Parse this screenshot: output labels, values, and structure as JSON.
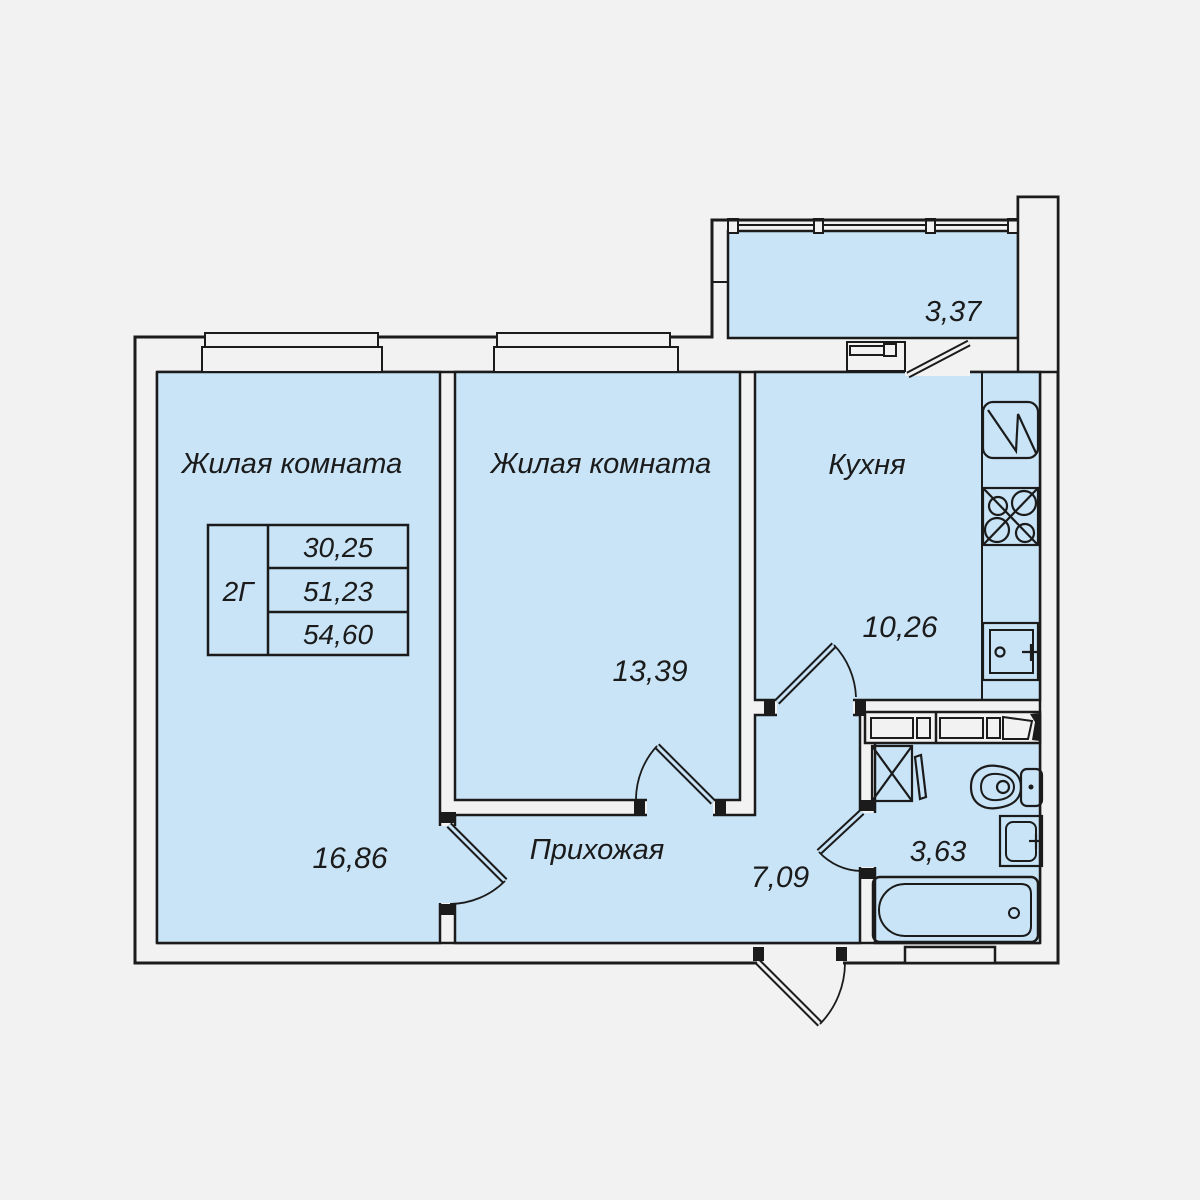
{
  "plan": {
    "type": "apartment-floor-plan",
    "unit": "2Г",
    "colors": {
      "background": "#f2f2f2",
      "room_fill": "#c9e4f7",
      "line": "#1b1b1b",
      "wall_fill": "#f2f2f2"
    },
    "info_table": {
      "unit_type": "2Г",
      "values": [
        "30,25",
        "51,23",
        "54,60"
      ]
    },
    "rooms": {
      "living_room_1": {
        "label": "Жилая комната",
        "area": "16,86"
      },
      "living_room_2": {
        "label": "Жилая комната",
        "area": "13,39"
      },
      "kitchen": {
        "label": "Кухня",
        "area": "10,26"
      },
      "hallway": {
        "label": "Прихожая",
        "area": "7,09"
      },
      "bathroom": {
        "label": "",
        "area": "3,63"
      },
      "balcony": {
        "label": "",
        "area": "3,37"
      }
    },
    "fixtures": [
      "fridge-icon",
      "stove-icon",
      "kitchen-sink-icon",
      "washing-machine-icon",
      "toilet-icon",
      "bathroom-sink-icon",
      "bathtub-icon",
      "shelf-icon",
      "vent-shaft",
      "window-icon",
      "balcony-glazing",
      "door-icon",
      "entrance-door-icon"
    ]
  }
}
